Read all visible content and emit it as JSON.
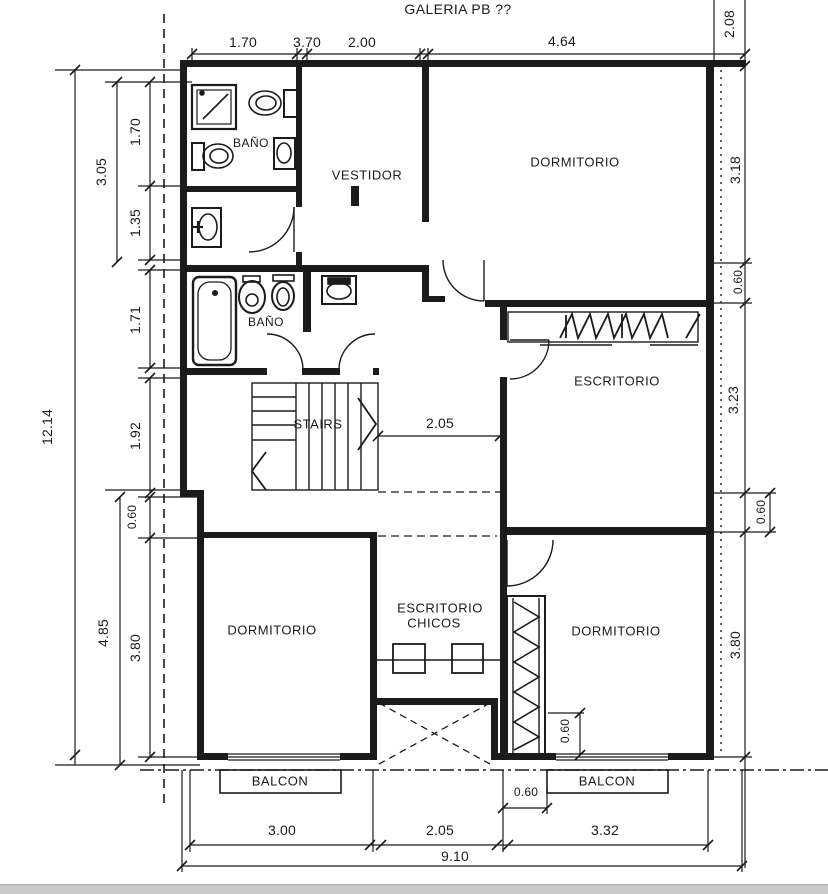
{
  "drawing": {
    "title": "GALERIA PB ??",
    "rooms": {
      "bano_top": "BAÑO",
      "vestidor": "VESTIDOR",
      "dormitorio_top": "DORMITORIO",
      "bano_mid": "BAÑO",
      "escritorio": "ESCRITORIO",
      "stairs": "STAIRS",
      "dormitorio_left": "DORMITORIO",
      "escritorio_chicos_l1": "ESCRITORIO",
      "escritorio_chicos_l2": "CHICOS",
      "dormitorio_right": "DORMITORIO",
      "balcon_left": "BALCON",
      "balcon_right": "BALCON"
    },
    "dims": {
      "top_1": "1.70",
      "top_2": "3.70",
      "top_3": "2.00",
      "top_4": "4.64",
      "right_0": "2.08",
      "right_1": "3.18",
      "right_2": "0.60",
      "right_3": "3.23",
      "right_4": "0.60",
      "right_5": "3.80",
      "left_total": "12.14",
      "left_1": "3.05",
      "left_1a": "1.70",
      "left_1b": "1.35",
      "left_2": "1.71",
      "left_3": "1.92",
      "left_4": "0.60",
      "left_5": "4.85",
      "left_6": "3.80",
      "inner_hall": "2.05",
      "inner_closet": "0.60",
      "balcony_gap": "0.60",
      "bottom_1": "3.00",
      "bottom_2": "2.05",
      "bottom_3": "3.32",
      "bottom_total": "9.10"
    }
  }
}
